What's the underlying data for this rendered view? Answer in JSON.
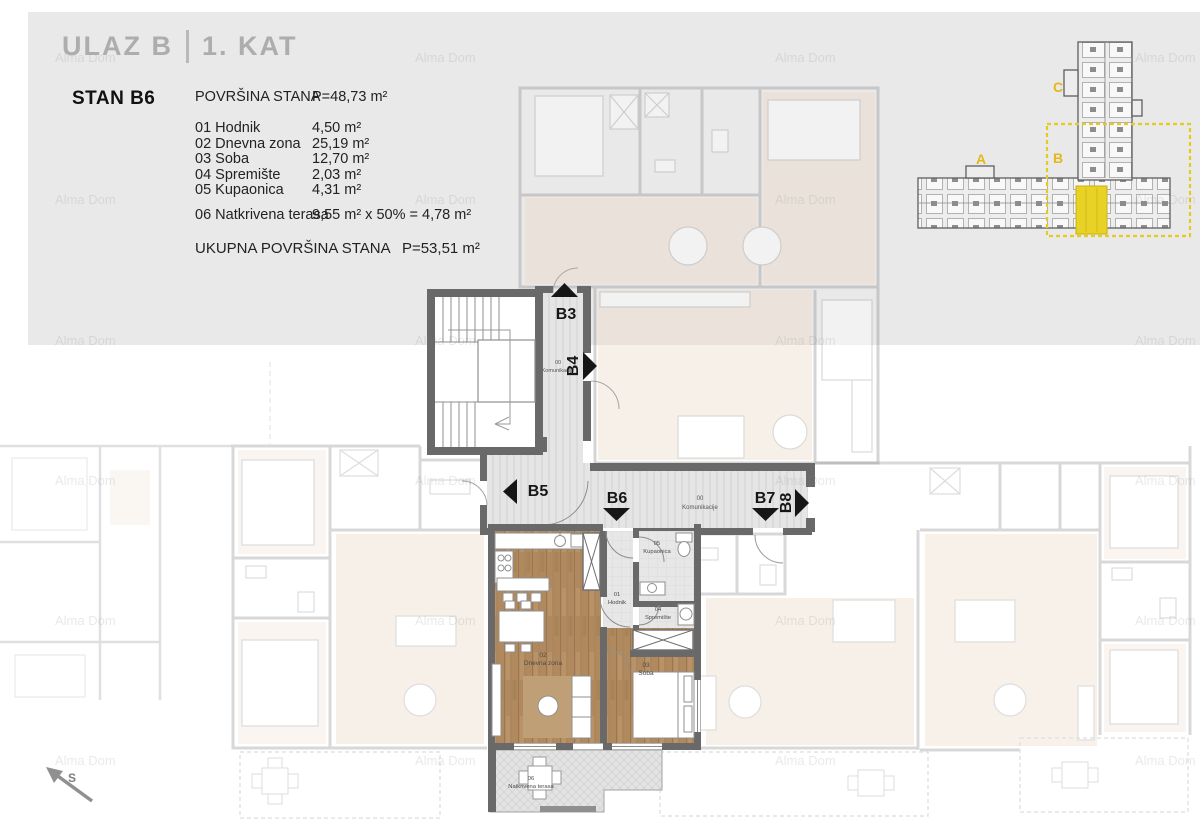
{
  "page": {
    "background": "#ffffff",
    "panel_color": "#e9e9e9",
    "wall_color": "#696969",
    "wood_color": "#b08a5e",
    "accent_yellow": "#e9d226",
    "label_yellow": "#e4b818"
  },
  "header": {
    "entrance": "ULAZ B",
    "floor": "1. KAT",
    "apartment": "STAN B6",
    "area_label": "POVRŠINA STANA",
    "area_value": "P=48,73 m²",
    "rooms": [
      {
        "num": "01",
        "name": "Hodnik",
        "area": "4,50 m²"
      },
      {
        "num": "02",
        "name": "Dnevna zona",
        "area": "25,19 m²"
      },
      {
        "num": "03",
        "name": "Soba",
        "area": "12,70 m²"
      },
      {
        "num": "04",
        "name": "Spremište",
        "area": "2,03 m²"
      },
      {
        "num": "05",
        "name": "Kupaonica",
        "area": "4,31 m²"
      }
    ],
    "terrace": {
      "num": "06",
      "name": "Natkrivena terasa",
      "calc": "9,55 m² x 50% = 4,78  m²"
    },
    "total_label": "UKUPNA POVRŠINA STANA",
    "total_value": "P=53,51 m²"
  },
  "overview": {
    "section_a": "A",
    "section_b": "B",
    "section_c": "C"
  },
  "plan": {
    "units": {
      "b3": "B3",
      "b4": "B4",
      "b5": "B5",
      "b6": "B6",
      "b7": "B7",
      "b8": "B8"
    },
    "corridor": {
      "num": "00",
      "name": "Komunikacije"
    },
    "rooms": {
      "hodnik": {
        "num": "01",
        "name": "Hodnik"
      },
      "dnevna": {
        "num": "02",
        "name": "Dnevna zona"
      },
      "soba": {
        "num": "03",
        "name": "Soba"
      },
      "spremiste": {
        "num": "04",
        "name": "Spremište"
      },
      "kupaonica": {
        "num": "05",
        "name": "Kupaonica"
      },
      "terasa": {
        "num": "06",
        "name": "Natkrivena terasa"
      }
    }
  },
  "compass": {
    "label": "S"
  },
  "watermark": {
    "text": "Alma Dom"
  }
}
